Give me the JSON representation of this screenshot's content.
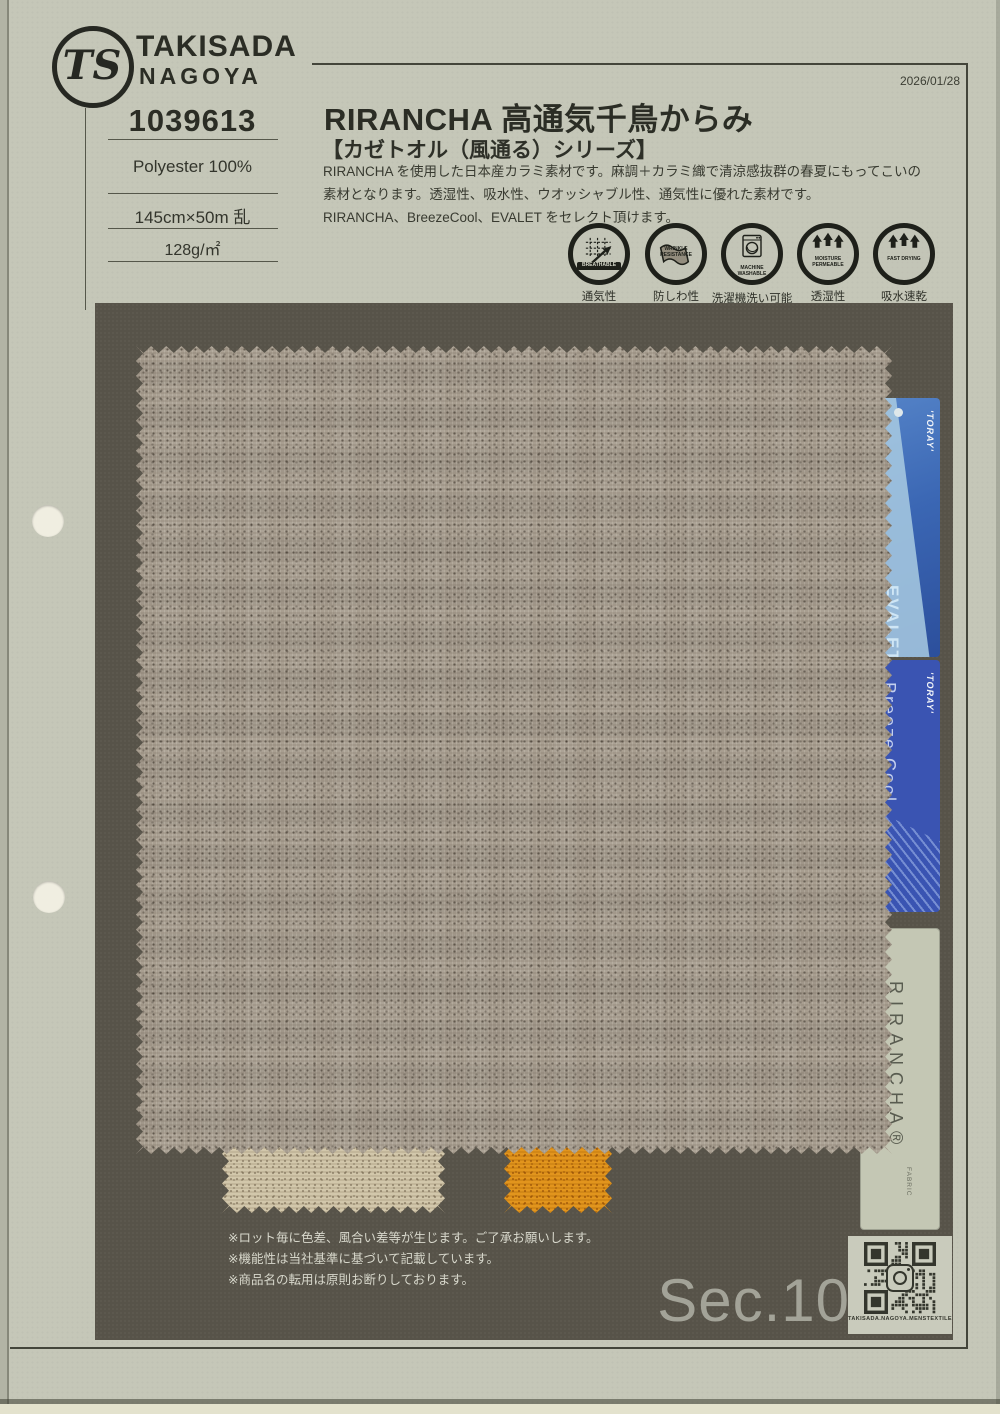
{
  "page": {
    "date": "2026/01/28",
    "section_label": "Sec.10"
  },
  "header": {
    "logo_monogram": "TS",
    "brand_line1": "TAKISADA",
    "brand_line2": "NAGOYA",
    "product_no": "1039613",
    "composition": "Polyester 100%",
    "width_length": "145cm×50m 乱",
    "weight": "128g/㎡",
    "title": "RIRANCHA 高通気千鳥からみ",
    "series": "【カゼトオル（風通る）シリーズ】",
    "description_line1": "RIRANCHA を使用した日本産カラミ素材です。麻調＋カラミ織で清涼感抜群の春夏にもってこいの",
    "description_line2": "素材となります。透湿性、吸水性、ウオッシャブル性、通気性に優れた素材です。",
    "description_line3": "RIRANCHA、BreezeCool、EVALET をセレクト頂けます。"
  },
  "badges": [
    {
      "icon": "breathable-icon",
      "en": "BREATHABLE",
      "jp": "通気性"
    },
    {
      "icon": "wrinkle-resistance-icon",
      "en": "WRINKLE RESISTANCE",
      "jp": "防しわ性"
    },
    {
      "icon": "machine-washable-icon",
      "en": "MACHINE WASHABLE",
      "jp": "洗濯機洗い可能"
    },
    {
      "icon": "moisture-permeable-icon",
      "en": "MOISTURE PERMEABLE",
      "jp": "透湿性"
    },
    {
      "icon": "fast-drying-icon",
      "en": "FAST DRYING",
      "jp": "吸水速乾"
    }
  ],
  "tags": {
    "evalet": {
      "brand": "'TORAY'",
      "name": "EVALET"
    },
    "breeze_cool": {
      "brand": "'TORAY'",
      "name": "Breeze Cool."
    },
    "rirancha": {
      "name": "RIRANCHA®",
      "sub": "FABRIC"
    }
  },
  "notes": [
    "※ロット毎に色差、風合い差等が生じます。ご了承お願いします。",
    "※機能性は当社基準に基づいて記載しています。",
    "※商品名の転用は原則お断りしております。"
  ],
  "qr": {
    "caption": "TAKISADA.NAGOYA.MENSTEXTILE"
  },
  "colors": {
    "page_bg": "#c5c7b8",
    "board_bg": "#575349",
    "fabric_taupe": "#a89e90",
    "fabric_beige": "#d2c7ab",
    "fabric_orange": "#e2951d",
    "tag_blue_evalet": "#3b67b4",
    "tag_blue_breeze": "#3a54b2",
    "tag_rirancha": "#c4c7b4",
    "section_text": "#a3a398",
    "notes_text": "#d8d8cc"
  }
}
